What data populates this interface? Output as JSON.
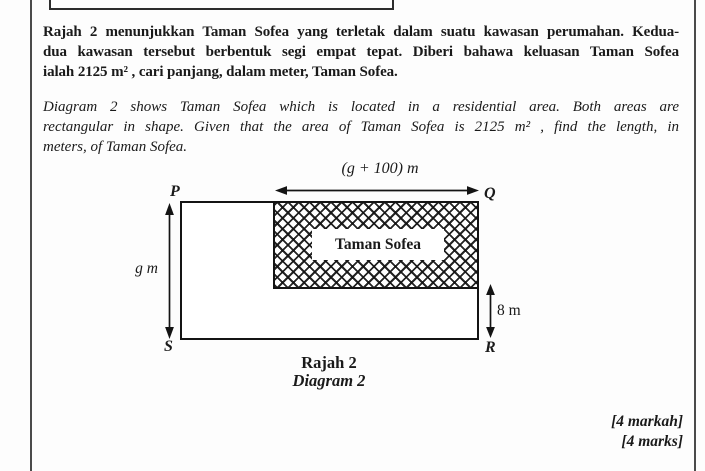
{
  "question_malay": {
    "lines": [
      "Rajah 2 menunjukkan Taman Sofea yang terletak dalam suatu kawasan perumahan. Kedua-",
      "dua kawasan tersebut berbentuk segi empat tepat. Diberi bahawa keluasan Taman Sofea",
      "ialah 2125 m² , cari panjang, dalam meter, Taman Sofea."
    ]
  },
  "question_english": {
    "lines": [
      "Diagram 2 shows Taman Sofea which is located in a residential area. Both areas are",
      "rectangular in shape. Given that the area of Taman Sofea is 2125 m² , find the length, in",
      "meters, of Taman Sofea."
    ]
  },
  "diagram": {
    "width_label": "(g + 100) m",
    "height_label": "g m",
    "offset_label": "8 m",
    "region_label": "Taman Sofea",
    "corner_top_left": "P",
    "corner_top_right": "Q",
    "corner_bottom_right": "R",
    "corner_bottom_left": "S",
    "caption_malay": "Rajah 2",
    "caption_english": "Diagram 2"
  },
  "marks": {
    "malay": "[4 markah]",
    "english": "[4 marks]"
  },
  "colors": {
    "ink": "#1a1a1a",
    "diagram_line": "#141414",
    "page_border": "#4a4a4a"
  }
}
